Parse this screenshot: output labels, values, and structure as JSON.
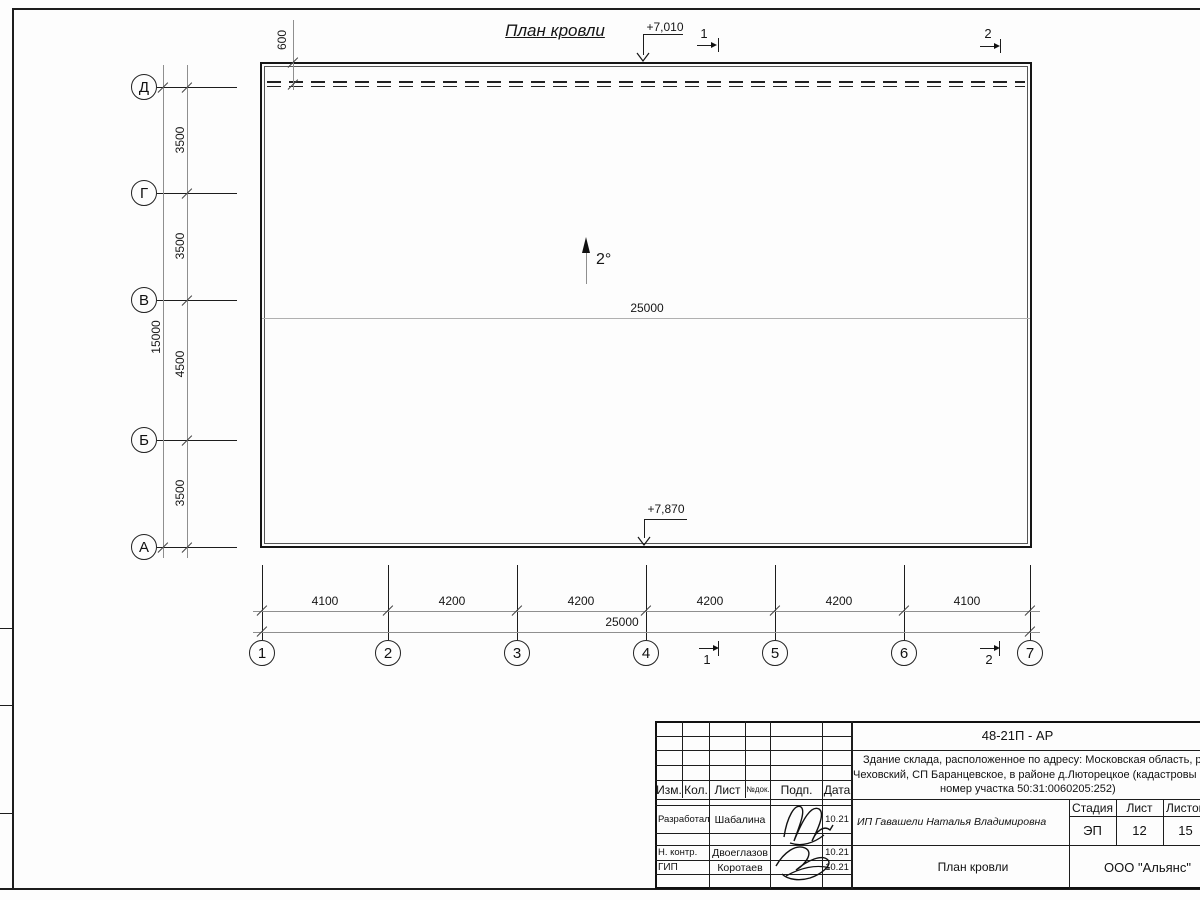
{
  "plan": {
    "title": "План кровли",
    "slope": "2°",
    "mid_width": "25000",
    "elev_top": "+7,010",
    "elev_bottom": "+7,870",
    "overhang_dim": "600",
    "section_one": "1",
    "section_two": "2"
  },
  "axes_left": {
    "labels": [
      "Д",
      "Г",
      "В",
      "Б",
      "А"
    ],
    "seg_dims": [
      "3500",
      "3500",
      "4500",
      "3500"
    ],
    "total_dim": "15000"
  },
  "axes_bottom": {
    "labels": [
      "1",
      "2",
      "3",
      "4",
      "5",
      "6",
      "7"
    ],
    "seg_dims": [
      "4100",
      "4200",
      "4200",
      "4200",
      "4200",
      "4100"
    ],
    "total_dim": "25000"
  },
  "titleblock": {
    "code": "48-21П - АР",
    "description_lines": [
      "Здание склада, расположенное по адресу: Московская область, р",
      "Чеховский, СП Баранцевское, в районе д.Люторецкое  (кадастровы",
      "номер участка 50:31:0060205:252)"
    ],
    "header_cols": [
      "Изм.",
      "Кол.",
      "Лист",
      "№док.",
      "Подп.",
      "Дата"
    ],
    "rows": [
      {
        "role": "Разработал",
        "name": "Шабалина",
        "date": "10.21"
      },
      {
        "role": "Н. контр.",
        "name": "Двоеглазов",
        "date": "10.21"
      },
      {
        "role": "ГИП",
        "name": "Коротаев",
        "date": "10.21"
      }
    ],
    "client": "ИП Гавашели Наталья Владимировна",
    "stage_header": [
      "Стадия",
      "Лист",
      "Листов"
    ],
    "stage_values": [
      "ЭП",
      "12",
      "15"
    ],
    "doc_title": "План кровли",
    "organization": "ООО \"Альянс\""
  },
  "colors": {
    "line_dark": "#1d1d1d",
    "line_gray": "#8f8f8f",
    "paper": "#fdfdfd"
  }
}
